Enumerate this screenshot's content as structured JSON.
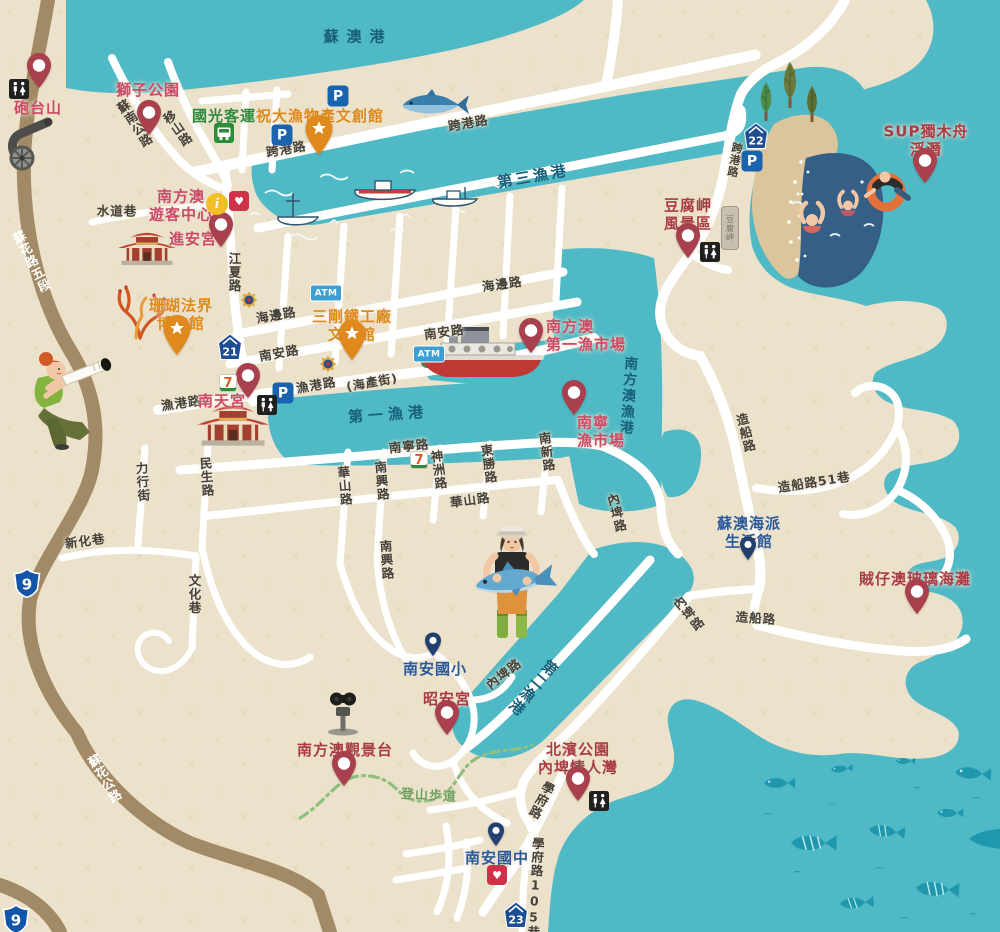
{
  "map": {
    "region_name": "南方澳",
    "colors": {
      "land": "#ece2cb",
      "water": "#4fb9c6",
      "water_deep": "#355f86",
      "beach": "#dcc49c",
      "road_white": "#ffffff",
      "road_brown": "#a28a66",
      "trail_green": "#8fbf7f",
      "label_rose": "#cb4a67",
      "label_red": "#a93b45",
      "label_orange": "#de8a1b",
      "label_blue": "#2b5a9b",
      "label_green": "#2f8a3d",
      "label_road": "#45413a",
      "label_water": "#19607a",
      "pin_red": "#a8404d",
      "pin_orange": "#e08a1e",
      "pin_blue": "#22406f"
    },
    "water_labels": [
      {
        "text": "蘇澳港",
        "x": 358,
        "y": 36,
        "rot": 0,
        "spacing": 8
      },
      {
        "text": "第三漁港",
        "x": 533,
        "y": 176,
        "rot": -10,
        "spacing": 3
      },
      {
        "text": "第一漁港",
        "x": 388,
        "y": 414,
        "rot": -4,
        "spacing": 5
      },
      {
        "text": "南方澳漁港",
        "x": 628,
        "y": 396,
        "rot": 4,
        "vertical": true,
        "spacing": 2,
        "size": 14
      },
      {
        "text": "第二漁港",
        "x": 533,
        "y": 688,
        "rot": 40,
        "vertical": true,
        "spacing": 2
      }
    ],
    "road_labels": [
      {
        "text": "蘇南公路",
        "x": 134,
        "y": 124,
        "rot": -33,
        "vertical": true
      },
      {
        "text": "移山路",
        "x": 177,
        "y": 129,
        "rot": -35,
        "vertical": true
      },
      {
        "text": "水道巷",
        "x": 117,
        "y": 210,
        "rot": 0
      },
      {
        "text": "跨港路",
        "x": 286,
        "y": 148,
        "rot": -10
      },
      {
        "text": "跨港路",
        "x": 468,
        "y": 122,
        "rot": -10
      },
      {
        "text": "跨港路",
        "x": 734,
        "y": 160,
        "rot": 10,
        "vertical": true,
        "size": 11
      },
      {
        "text": "江夏路",
        "x": 234,
        "y": 272,
        "rot": 0,
        "vertical": true
      },
      {
        "text": "海邊路",
        "x": 276,
        "y": 314,
        "rot": -10
      },
      {
        "text": "海邊路",
        "x": 502,
        "y": 283,
        "rot": -8
      },
      {
        "text": "南安路",
        "x": 279,
        "y": 352,
        "rot": -10
      },
      {
        "text": "南安路",
        "x": 444,
        "y": 331,
        "rot": -8
      },
      {
        "text": "漁港路",
        "x": 181,
        "y": 402,
        "rot": -8
      },
      {
        "text": "漁港路",
        "x": 316,
        "y": 384,
        "rot": -10
      },
      {
        "text": "(海產街)",
        "x": 372,
        "y": 382,
        "rot": -10,
        "size": 12
      },
      {
        "text": "南寧路",
        "x": 409,
        "y": 445,
        "rot": -6
      },
      {
        "text": "力行街",
        "x": 142,
        "y": 482,
        "rot": -4,
        "vertical": true
      },
      {
        "text": "民生路",
        "x": 206,
        "y": 477,
        "rot": -4,
        "vertical": true
      },
      {
        "text": "華山路",
        "x": 344,
        "y": 486,
        "rot": -5,
        "vertical": true
      },
      {
        "text": "南興路",
        "x": 381,
        "y": 481,
        "rot": -5,
        "vertical": true
      },
      {
        "text": "神洲路",
        "x": 438,
        "y": 470,
        "rot": -8,
        "vertical": true
      },
      {
        "text": "東勝路",
        "x": 488,
        "y": 464,
        "rot": -8,
        "vertical": true
      },
      {
        "text": "南新路",
        "x": 546,
        "y": 452,
        "rot": -8,
        "vertical": true
      },
      {
        "text": "華山路",
        "x": 470,
        "y": 499,
        "r": 0,
        "rot": -8
      },
      {
        "text": "南興路",
        "x": 386,
        "y": 560,
        "rot": -4,
        "vertical": true
      },
      {
        "text": "內埤路",
        "x": 616,
        "y": 513,
        "rot": -14,
        "vertical": true
      },
      {
        "text": "內埤路",
        "x": 688,
        "y": 614,
        "rot": -40,
        "vertical": true
      },
      {
        "text": "內埤路",
        "x": 503,
        "y": 673,
        "rot": -38
      },
      {
        "text": "造船路",
        "x": 745,
        "y": 433,
        "rot": -14,
        "vertical": true
      },
      {
        "text": "造船路51巷",
        "x": 814,
        "y": 481,
        "rot": -9,
        "size": 12.5
      },
      {
        "text": "造船路",
        "x": 756,
        "y": 617,
        "rot": 4
      },
      {
        "text": "新化巷",
        "x": 85,
        "y": 540,
        "rot": -8
      },
      {
        "text": "文化巷",
        "x": 194,
        "y": 594,
        "rot": 0,
        "vertical": true
      },
      {
        "text": "學府路",
        "x": 541,
        "y": 800,
        "rot": 27,
        "vertical": true
      },
      {
        "text": "學府路105巷",
        "x": 535,
        "y": 888,
        "rot": 3,
        "vertical": true,
        "size": 12.5
      },
      {
        "text": "蘇花路五段",
        "x": 31,
        "y": 262,
        "rot": -27,
        "vertical": true,
        "onbrown": true
      },
      {
        "text": "蘇花公路",
        "x": 104,
        "y": 779,
        "rot": -30,
        "vertical": true,
        "onbrown": true
      },
      {
        "text": "登山步道",
        "x": 429,
        "y": 794,
        "rot": 3,
        "trail": true,
        "size": 13
      }
    ],
    "pois": [
      {
        "id": "paotai-mountain",
        "lines": [
          "砲台山"
        ],
        "x": 38,
        "y": 109,
        "color": "rose",
        "pin": {
          "type": "red",
          "x": 39,
          "y": 93
        }
      },
      {
        "id": "lion-park",
        "lines": [
          "獅子公園"
        ],
        "x": 148,
        "y": 91,
        "color": "rose",
        "pin": {
          "type": "red",
          "x": 149,
          "y": 140
        }
      },
      {
        "id": "visitor-center",
        "lines": [
          "南方澳",
          "遊客中心"
        ],
        "x": 181,
        "y": 206,
        "color": "rose",
        "pin": null
      },
      {
        "id": "jinan-temple",
        "lines": [
          "進安宮"
        ],
        "x": 193,
        "y": 240,
        "color": "rose",
        "pin": {
          "type": "red",
          "x": 221,
          "y": 252
        }
      },
      {
        "id": "coral-museum",
        "lines": [
          "珊瑚法界",
          "博物館"
        ],
        "x": 181,
        "y": 315,
        "color": "orange",
        "pin": {
          "type": "star",
          "x": 177,
          "y": 360
        }
      },
      {
        "id": "zhudayu-museum",
        "lines": [
          "祝大漁物產文創館"
        ],
        "x": 320,
        "y": 117,
        "color": "orange",
        "pin": {
          "type": "star",
          "x": 319,
          "y": 160
        }
      },
      {
        "id": "sangang-ironworks",
        "lines": [
          "三剛鐵工廠",
          "文物館"
        ],
        "x": 352,
        "y": 326,
        "color": "orange",
        "pin": {
          "type": "star",
          "x": 352,
          "y": 365
        }
      },
      {
        "id": "kuokuang-bus",
        "lines": [
          "國光客運"
        ],
        "x": 224,
        "y": 117,
        "color": "green",
        "pin": null
      },
      {
        "id": "first-fish-market",
        "lines": [
          "南方澳",
          "第一漁市場"
        ],
        "x": 546,
        "y": 336,
        "color": "rose",
        "align": "left",
        "pin": {
          "type": "red",
          "x": 531,
          "y": 358
        }
      },
      {
        "id": "nanning-fish-market",
        "lines": [
          "南寧",
          "漁市場"
        ],
        "x": 577,
        "y": 432,
        "color": "rose",
        "align": "left",
        "pin": {
          "type": "red",
          "x": 574,
          "y": 420
        }
      },
      {
        "id": "nantian-temple",
        "lines": [
          "南天宮"
        ],
        "x": 222,
        "y": 402,
        "color": "rose",
        "pin": {
          "type": "red",
          "x": 248,
          "y": 403
        }
      },
      {
        "id": "doufu-cape",
        "lines": [
          "豆腐岬",
          "風景區"
        ],
        "x": 688,
        "y": 215,
        "color": "red",
        "pin": {
          "type": "red",
          "x": 688,
          "y": 263
        }
      },
      {
        "id": "sup-kayak",
        "lines": [
          "SUP獨木舟",
          "浮潛"
        ],
        "x": 926,
        "y": 141,
        "color": "red",
        "pin": {
          "type": "red",
          "x": 925,
          "y": 188
        }
      },
      {
        "id": "suao-lifestyle-hall",
        "lines": [
          "蘇澳海派",
          "生活館"
        ],
        "x": 749,
        "y": 533,
        "color": "blue",
        "pin": {
          "type": "blue",
          "x": 748,
          "y": 565
        }
      },
      {
        "id": "glass-beach",
        "lines": [
          "賊仔澳玻璃海灘"
        ],
        "x": 915,
        "y": 580,
        "color": "red",
        "pin": {
          "type": "red",
          "x": 917,
          "y": 619
        }
      },
      {
        "id": "nanan-elementary",
        "lines": [
          "南安國小"
        ],
        "x": 435,
        "y": 670,
        "color": "blue",
        "pin": {
          "type": "blue",
          "x": 433,
          "y": 661
        }
      },
      {
        "id": "zhaoan-temple",
        "lines": [
          "昭安宮"
        ],
        "x": 447,
        "y": 700,
        "color": "red",
        "pin": {
          "type": "red",
          "x": 447,
          "y": 740
        }
      },
      {
        "id": "observation-deck",
        "lines": [
          "南方澳觀景台"
        ],
        "x": 345,
        "y": 751,
        "color": "red",
        "pin": {
          "type": "red",
          "x": 344,
          "y": 791
        }
      },
      {
        "id": "beibin-park",
        "lines": [
          "北濱公園",
          "內埤情人灣"
        ],
        "x": 578,
        "y": 759,
        "color": "red",
        "pin": {
          "type": "red",
          "x": 578,
          "y": 806
        }
      },
      {
        "id": "nanan-junior-high",
        "lines": [
          "南安國中"
        ],
        "x": 497,
        "y": 859,
        "color": "blue",
        "pin": {
          "type": "blue",
          "x": 496,
          "y": 851
        }
      }
    ],
    "icons": [
      {
        "type": "parking",
        "x": 338,
        "y": 96
      },
      {
        "type": "parking",
        "x": 282,
        "y": 135
      },
      {
        "type": "parking",
        "x": 752,
        "y": 161
      },
      {
        "type": "parking",
        "x": 283,
        "y": 393
      },
      {
        "type": "atm",
        "x": 326,
        "y": 293
      },
      {
        "type": "atm",
        "x": 429,
        "y": 354
      },
      {
        "type": "toilet",
        "x": 19,
        "y": 89
      },
      {
        "type": "toilet",
        "x": 267,
        "y": 405
      },
      {
        "type": "toilet",
        "x": 710,
        "y": 252
      },
      {
        "type": "toilet",
        "x": 599,
        "y": 801
      },
      {
        "type": "aed",
        "x": 239,
        "y": 201
      },
      {
        "type": "aed",
        "x": 497,
        "y": 875
      },
      {
        "type": "info",
        "x": 217,
        "y": 204
      },
      {
        "type": "seven",
        "x": 228,
        "y": 383
      },
      {
        "type": "seven",
        "x": 419,
        "y": 460
      },
      {
        "type": "bus",
        "x": 224,
        "y": 133
      },
      {
        "type": "police",
        "x": 249,
        "y": 300
      },
      {
        "type": "police",
        "x": 328,
        "y": 364
      },
      {
        "type": "house-shield",
        "text": "21",
        "x": 230,
        "y": 347
      },
      {
        "type": "house-shield",
        "text": "22",
        "x": 756,
        "y": 136
      },
      {
        "type": "house-shield",
        "text": "23",
        "x": 516,
        "y": 915
      },
      {
        "type": "hwy-shield",
        "text": "9",
        "x": 27,
        "y": 583
      },
      {
        "type": "hwy-shield",
        "text": "9",
        "x": 16,
        "y": 919
      },
      {
        "type": "monument",
        "text": "豆腐岬",
        "x": 730,
        "y": 228
      }
    ],
    "illustrations": [
      {
        "name": "cannon",
        "x": 22,
        "y": 146
      },
      {
        "name": "tuna",
        "x": 433,
        "y": 104
      },
      {
        "name": "harborboats",
        "x": 360,
        "y": 205
      },
      {
        "name": "temple-jinan",
        "x": 147,
        "y": 254,
        "scale": 0.85
      },
      {
        "name": "temple-nantian",
        "x": 233,
        "y": 432,
        "scale": 1.05
      },
      {
        "name": "coral",
        "x": 136,
        "y": 312
      },
      {
        "name": "woman",
        "x": 60,
        "y": 402
      },
      {
        "name": "bigboat",
        "x": 483,
        "y": 360
      },
      {
        "name": "fisherman",
        "x": 512,
        "y": 594
      },
      {
        "name": "viewer",
        "x": 343,
        "y": 712
      },
      {
        "name": "beach-swimmers",
        "x": 850,
        "y": 200
      },
      {
        "name": "trees",
        "x": 790,
        "y": 102
      },
      {
        "name": "fish-school",
        "x": 872,
        "y": 845
      }
    ]
  }
}
